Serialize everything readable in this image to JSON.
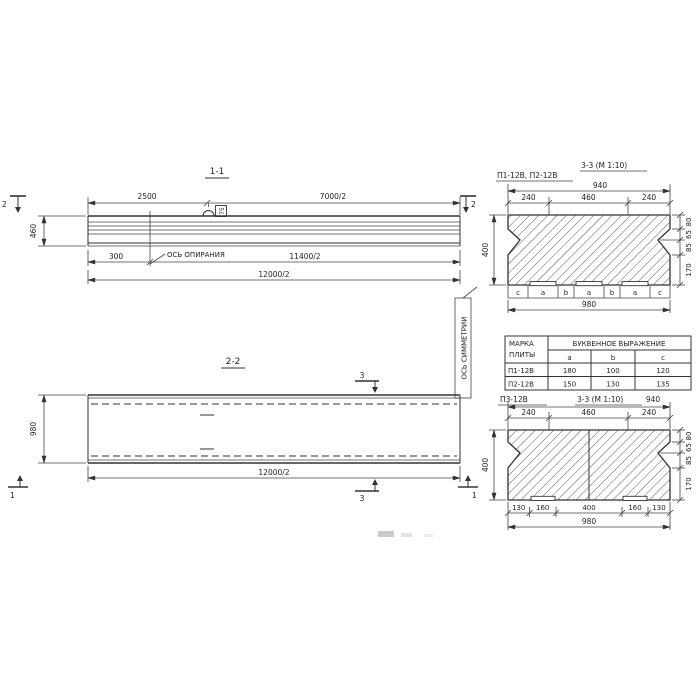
{
  "colors": {
    "ink": "#333333",
    "background": "#ffffff"
  },
  "section_1_1": {
    "title": "1-1",
    "cut_label_left": "2",
    "cut_label_right": "2",
    "dim_top_left": "2500",
    "dim_top_right": "7000/2",
    "dim_height": "460",
    "dim_support": "300",
    "support_axis_label": "ОСЬ ОПИРАНИЯ",
    "dim_half_span": "11400/2",
    "dim_full_span": "12000/2",
    "loop_tag": "75"
  },
  "section_2_2": {
    "title": "2-2",
    "dim_width": "980",
    "dim_span": "12000/2",
    "cut_label_3_top": "3",
    "cut_label_3_bottom": "3",
    "cut_label_1_left": "1",
    "cut_label_1_right": "1",
    "symmetry_axis_label": "ОСЬ СИММЕТРИИ"
  },
  "section_3_3_upper": {
    "marks_label": "П1-12В, П2-12В",
    "title": "3-3 (М 1:10)",
    "dim_overall_top": "940",
    "dims_top": [
      "240",
      "460",
      "240"
    ],
    "dim_height": "400",
    "dims_right": [
      "80",
      "65",
      "85",
      "170"
    ],
    "letter_row": [
      "c",
      "a",
      "b",
      "a",
      "b",
      "a",
      "c"
    ],
    "dim_overall_bottom": "980"
  },
  "table": {
    "header_col1": [
      "МАРКА",
      "ПЛИТЫ"
    ],
    "header_span": "БУКВЕННОЕ  ВЫРАЖЕНИЕ",
    "sub_headers": [
      "a",
      "b",
      "c"
    ],
    "rows": [
      {
        "mark": "П1-12В",
        "a": "180",
        "b": "100",
        "c": "120"
      },
      {
        "mark": "П2-12В",
        "a": "150",
        "b": "130",
        "c": "135"
      }
    ]
  },
  "section_3_3_lower": {
    "mark_label": "П3-12В",
    "title": "3-3 (М 1:10)",
    "dim_overall_top": "940",
    "dims_top": [
      "240",
      "460",
      "240"
    ],
    "dim_height": "400",
    "dims_right": [
      "80",
      "65",
      "85",
      "170"
    ],
    "dims_bottom": [
      "130",
      "160",
      "400",
      "160",
      "130"
    ],
    "dim_overall_bottom": "980"
  }
}
